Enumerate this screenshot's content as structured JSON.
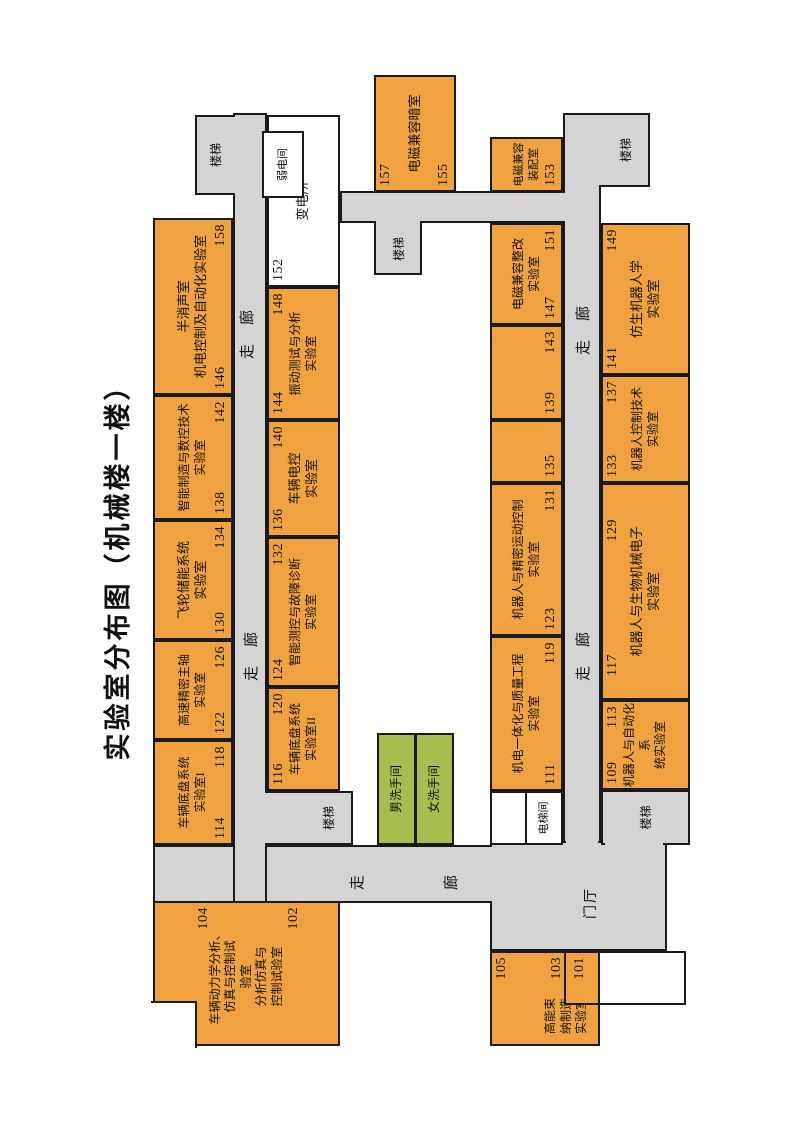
{
  "title": "实验室分布图（机械楼一楼）",
  "colors": {
    "room_orange": "#f1a240",
    "toilet_green": "#a6be4f",
    "corridor_gray": "#d4d4d4",
    "wall_black": "#1a1a1a",
    "utility_white": "#ffffff"
  },
  "corridor": {
    "pair": "走　廊",
    "zou": "走",
    "lang": "廊"
  },
  "areas": {
    "lobby": "门厅",
    "stairs": "楼梯",
    "elevator": "电梯间",
    "mens_toilet": "男洗手间",
    "womens_toilet": "女洗手间"
  },
  "rooms": [
    {
      "label": "车辆底盘系统\n实验室I",
      "nums": [
        "114",
        "118"
      ]
    },
    {
      "label": "高速精密主轴\n实验室",
      "nums": [
        "122",
        "126"
      ]
    },
    {
      "label": "飞轮储能系统\n实验室",
      "nums": [
        "130",
        "134"
      ]
    },
    {
      "label": "智能制造与数控技术\n实验室",
      "nums": [
        "138",
        "142"
      ]
    },
    {
      "label": "半消声室\n机电控制及自动化实验室",
      "nums": [
        "146",
        "158"
      ]
    },
    {
      "label": "车辆底盘系统\n实验室II",
      "nums": [
        "116",
        "120"
      ]
    },
    {
      "label": "智能测控与故障诊断\n实验室",
      "nums": [
        "124",
        "132"
      ]
    },
    {
      "label": "车辆电控\n实验室",
      "nums": [
        "136",
        "140"
      ]
    },
    {
      "label": "振动测试与分析\n实验室",
      "nums": [
        "144",
        "148"
      ]
    },
    {
      "label": "变电所",
      "nums": [
        "152"
      ]
    },
    {
      "label": "弱电间",
      "nums": []
    },
    {
      "label": "车辆动力学分析、\n仿真与控制试\n验室\n分析仿真与\n控制试验室",
      "nums": [
        "104",
        "102"
      ]
    },
    {
      "label": "高能束\n纳制造\n实验室",
      "nums": [
        "105",
        "103",
        "101"
      ]
    },
    {
      "label": "机电一体化与质量工程\n实验室",
      "nums": [
        "111",
        "119"
      ]
    },
    {
      "label": "机器人与精密运动控制\n实验室",
      "nums": [
        "123",
        "131"
      ]
    },
    {
      "label": "",
      "nums": [
        "135"
      ]
    },
    {
      "label": "",
      "nums": [
        "139",
        "143"
      ]
    },
    {
      "label": "电磁兼容整改\n实验室",
      "nums": [
        "147",
        "151"
      ]
    },
    {
      "label": "电磁兼容暗室",
      "nums": [
        "157",
        "155"
      ]
    },
    {
      "label": "电磁兼容\n装配室",
      "nums": [
        "153"
      ]
    },
    {
      "label": "机器人与自动化系\n统实验室",
      "nums": [
        "109",
        "113"
      ]
    },
    {
      "label": "机器人与生物机械电子\n实验室",
      "nums": [
        "117",
        "129"
      ]
    },
    {
      "label": "机器人控制技术\n实验室",
      "nums": [
        "133",
        "137"
      ]
    },
    {
      "label": "仿生机器人学\n实验室",
      "nums": [
        "141",
        "149"
      ]
    }
  ]
}
